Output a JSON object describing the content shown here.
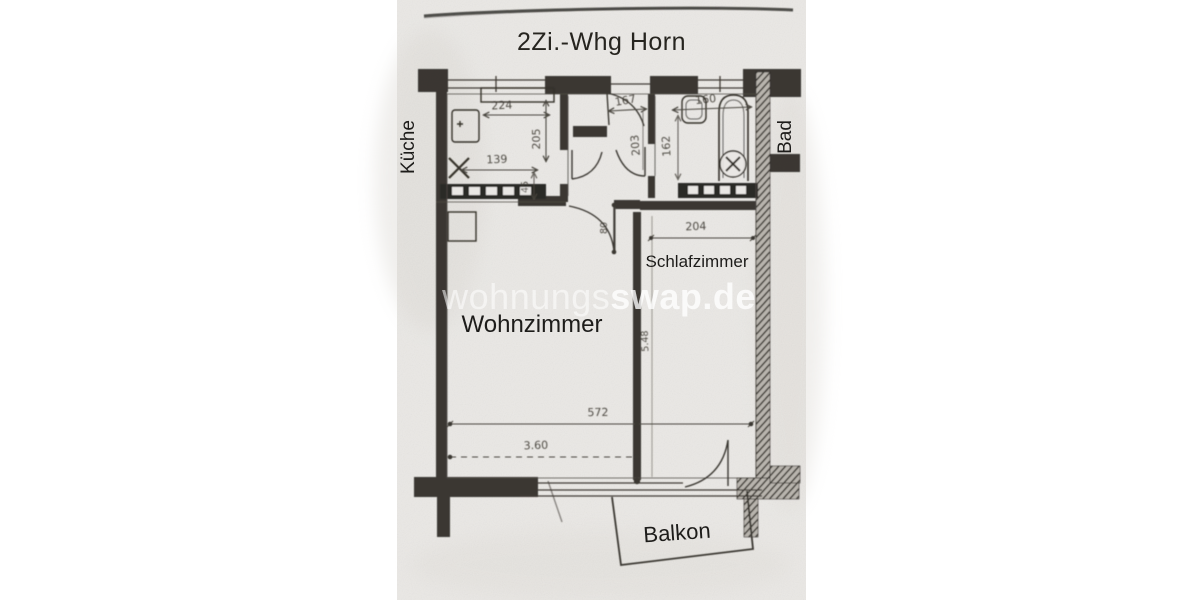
{
  "plan": {
    "title": "2Zi.-Whg Horn"
  },
  "rooms": {
    "kitchen": "Küche",
    "bath": "Bad",
    "bedroom": "Schlafzimmer",
    "living": "Wohnzimmer",
    "balcony": "Balkon"
  },
  "watermark": {
    "left": "wohnungs",
    "right": "swap.de"
  },
  "measurements": {
    "kitchen_width": "224",
    "entrance_width": "167",
    "bath_width": "160",
    "kitchen_depth": "205",
    "kitchen_inner_width": "139",
    "hall_depth": "203",
    "bath_depth": "162",
    "kitchen_passage": "45",
    "living_door_width": "80",
    "bedroom_width": "204",
    "apartment_width": "572",
    "living_width": "3.60",
    "room_depth": "5.48"
  },
  "colors": {
    "paper": "#eae8e5",
    "ink": "#2b2925",
    "pencil": "#4a463f",
    "label": "#1d1c1a",
    "watermark": "#ffffff"
  }
}
